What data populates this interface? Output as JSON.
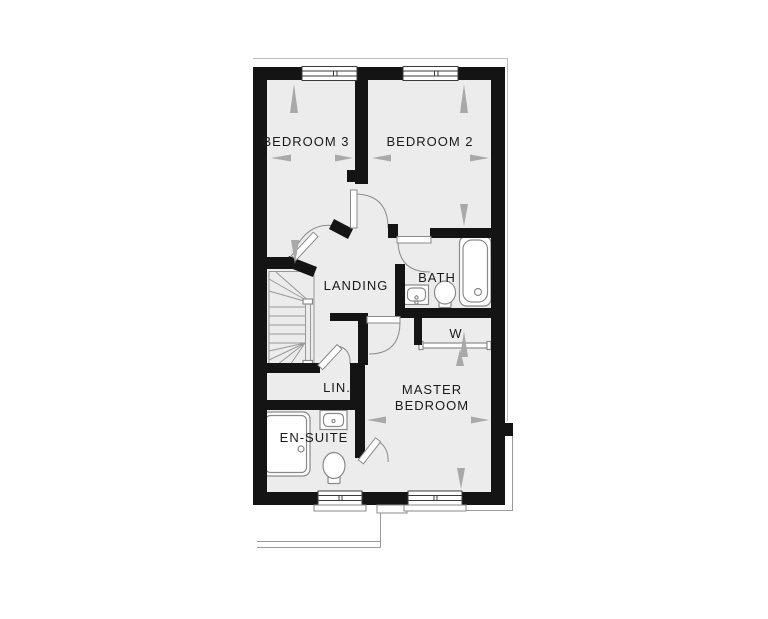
{
  "floor_plan": {
    "rooms": {
      "bedroom3": "BEDROOM 3",
      "bedroom2": "BEDROOM 2",
      "landing": "LANDING",
      "bath": "BATH",
      "wardrobe": "W",
      "linen": "LIN.",
      "master_line1": "MASTER",
      "master_line2": "BEDROOM",
      "ensuite": "EN-SUITE"
    },
    "colors": {
      "wall": "#141414",
      "room_fill": "#ececec",
      "fixture_line": "#8a8a8a",
      "arrow": "#a9a9a9",
      "text": "#1a1a1a",
      "background": "#ffffff"
    }
  }
}
